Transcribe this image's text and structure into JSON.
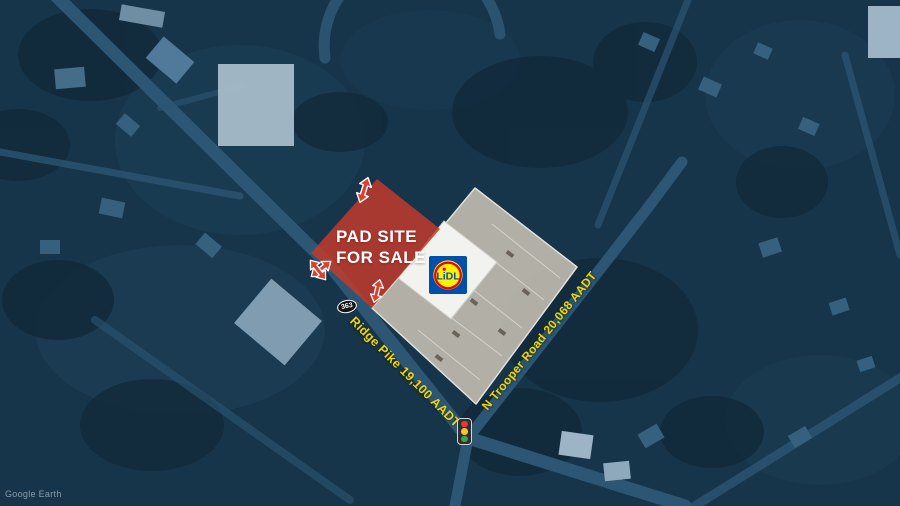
{
  "map": {
    "attribution": "Google Earth",
    "pad_site": {
      "label_line1": "PAD SITE",
      "label_line2": "FOR SALE",
      "fill_color": "#c23b2c",
      "text_color": "#ffffff"
    },
    "roads": {
      "ridge_pike_label": "Ridge Pike 19,100 AADT",
      "n_trooper_label": "N Trooper Road 20,068 AADT",
      "label_color": "#f2d600",
      "route_shield": "363"
    },
    "store": {
      "brand": "LiDL",
      "logo_blue": "#0050aa",
      "logo_yellow": "#fff000",
      "logo_red": "#e3000f"
    },
    "traffic_light_colors": {
      "red": "#e53935",
      "yellow": "#fbc02d",
      "green": "#43a047"
    },
    "access_arrow_color": "#d8402f"
  }
}
